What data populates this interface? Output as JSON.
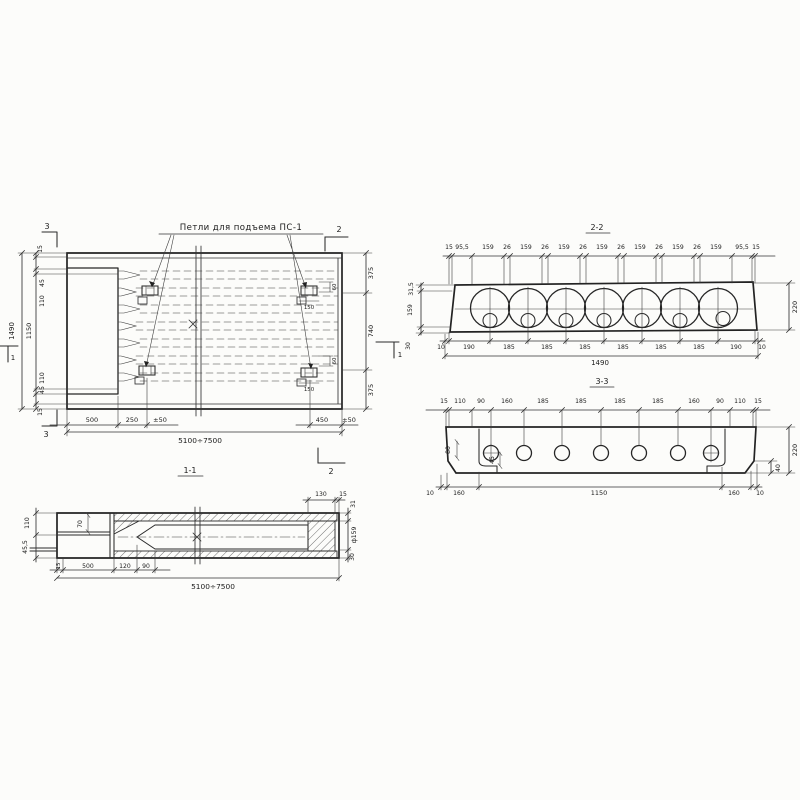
{
  "plan": {
    "loops_label": "Петли для подъема ПС-1",
    "left_overall": "1490",
    "left_chain": [
      "15",
      "45",
      "110",
      "1150",
      "110",
      "45",
      "15"
    ],
    "right_chain": [
      "375",
      "740",
      "375"
    ],
    "bottom_chain": [
      "500",
      "250",
      "±50",
      "450",
      "±50"
    ],
    "bottom_overall": "5100÷7500",
    "marker_top_left": "3",
    "marker_bottom_left": "3",
    "marker_top_right": "2",
    "marker_bottom_right": "2",
    "marker_left": "1",
    "marker_right": "1",
    "loop_dim_60_top": "60",
    "loop_dim_60_bottom": "60",
    "loop_dim_150_top": "150",
    "loop_dim_150_bottom": "150"
  },
  "sec22": {
    "title": "2-2",
    "top": [
      "15",
      "95,5",
      "159",
      "26",
      "159",
      "26",
      "159",
      "26",
      "159",
      "26",
      "159",
      "26",
      "159",
      "26",
      "159",
      "95,5",
      "15"
    ],
    "left": [
      "31,5",
      "159",
      "30"
    ],
    "right": "220",
    "bottom": [
      "10",
      "190",
      "185",
      "185",
      "185",
      "185",
      "185",
      "185",
      "190",
      "10"
    ],
    "overall": "1490"
  },
  "sec33": {
    "title": "3-3",
    "top": [
      "15",
      "110",
      "90",
      "160",
      "185",
      "185",
      "185",
      "185",
      "160",
      "90",
      "110",
      "15"
    ],
    "bottom": [
      "10",
      "160",
      "1150",
      "160",
      "10"
    ],
    "right": "220",
    "d80": "80",
    "d45": "45",
    "d40": "40"
  },
  "sec11": {
    "title": "1-1",
    "left": [
      "110",
      "45,5"
    ],
    "d70": "70",
    "bottom": [
      "15",
      "500",
      "120",
      "90"
    ],
    "overall": "5100÷7500",
    "top_right": [
      "130",
      "15"
    ],
    "right": [
      "31",
      "ф159",
      "30"
    ]
  }
}
